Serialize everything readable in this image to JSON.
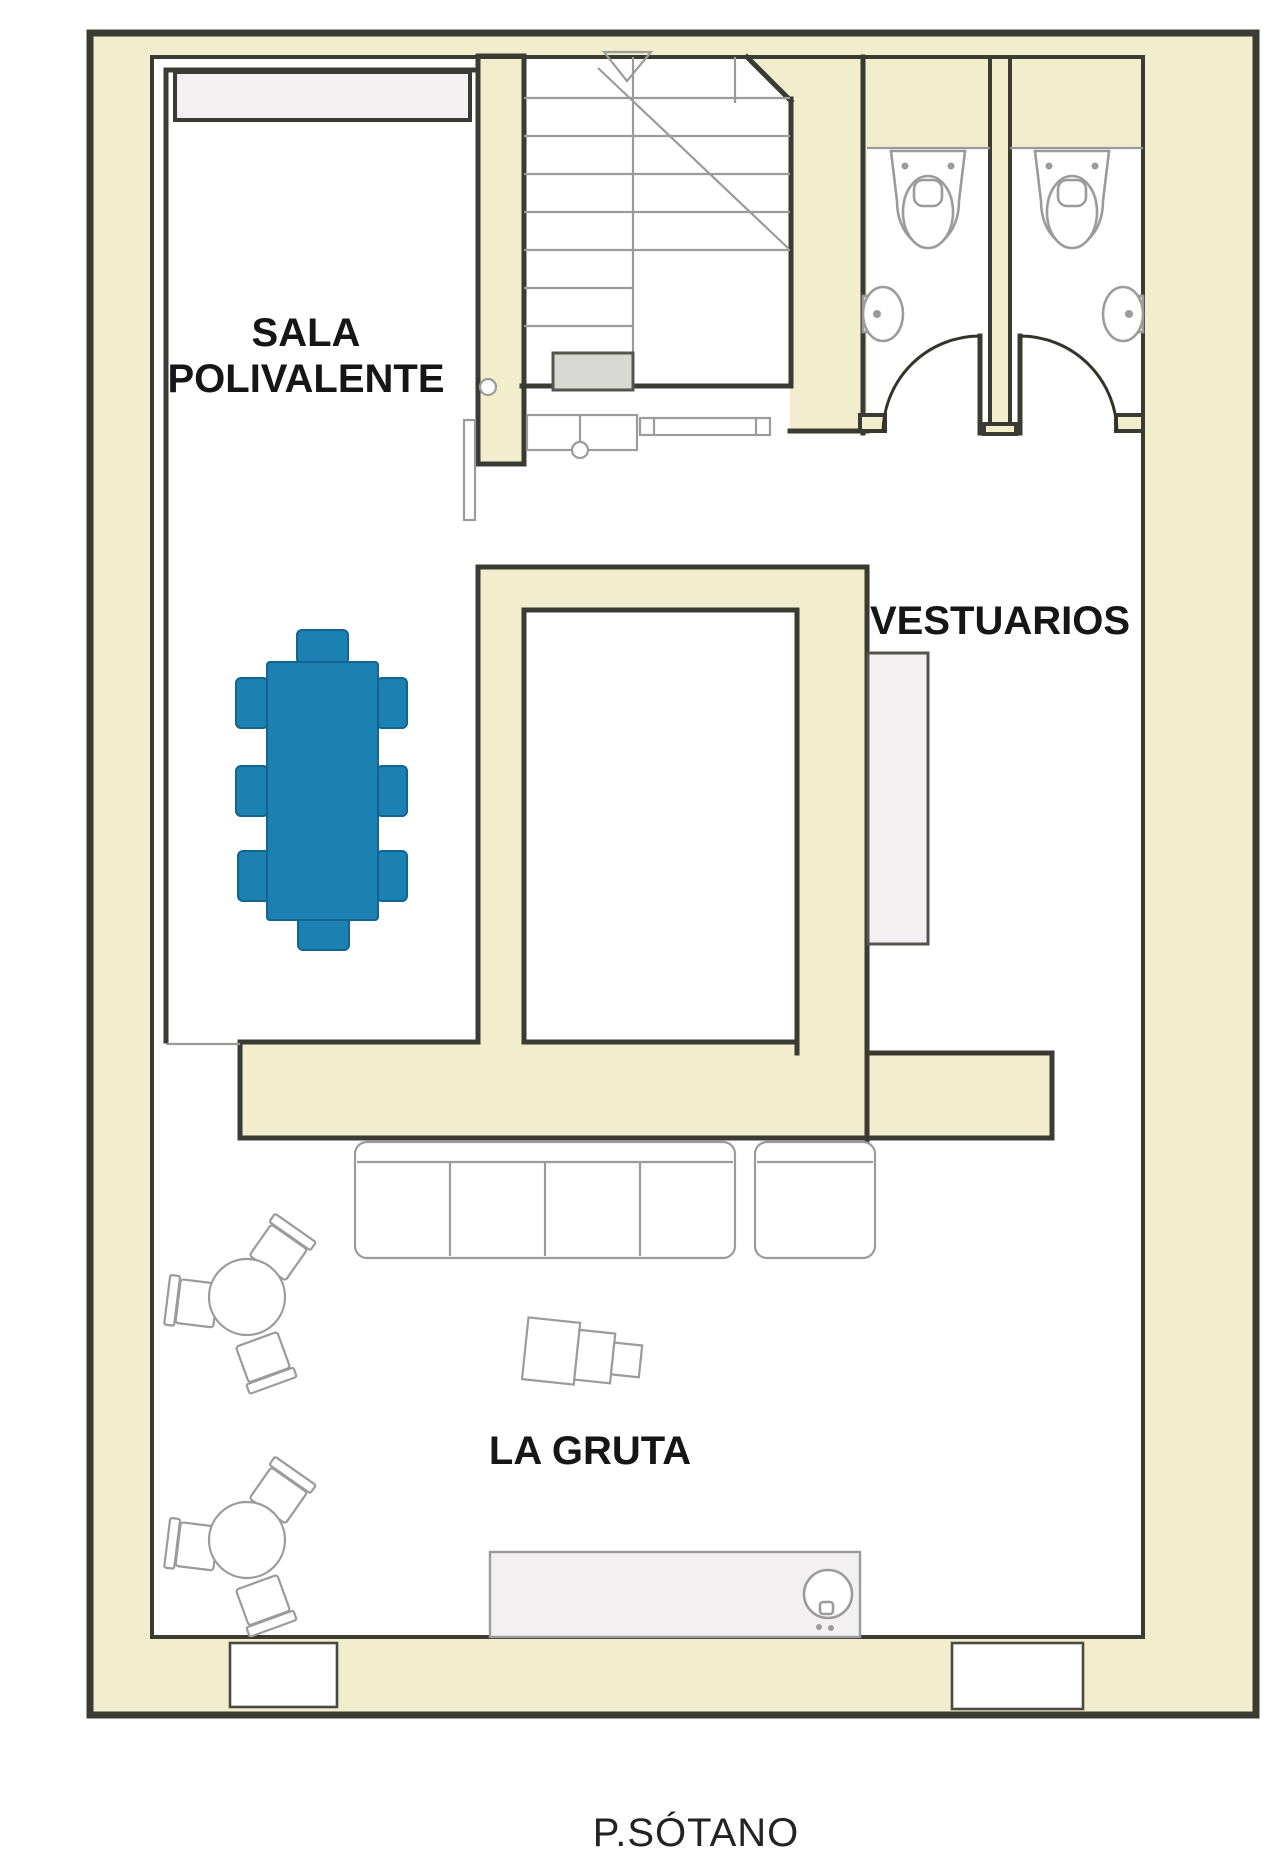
{
  "drawing": {
    "type": "architectural-floor-plan",
    "floor_label": "P.SÓTANO"
  },
  "rooms": {
    "sala": {
      "label_line1": "SALA",
      "label_line2": "POLIVALENTE"
    },
    "vestuarios": {
      "label": "VESTUARIOS"
    },
    "gruta": {
      "label": "LA GRUTA"
    }
  },
  "fixtures": [
    "stairs-with-down-arrow-icon",
    "toilet-icon",
    "toilet-icon",
    "wall-sink-icon",
    "wall-sink-icon",
    "door-swing-arc-icon",
    "door-swing-arc-icon",
    "door-leaf-icon",
    "meeting-table-with-chairs",
    "wardrobe-cabinet",
    "bench",
    "sofa-row",
    "sofa-short",
    "round-table-with-chairs",
    "round-table-with-chairs",
    "armchair-with-side-tables",
    "bar-counter-with-sink"
  ],
  "colors": {
    "background": "#ffffff",
    "wall": "#f2eecd",
    "line": "#3b3b33",
    "thin": "#9b9b9b",
    "accent": "#1b80b2",
    "accent_dark": "#14648e",
    "fixture": "#f3f0f2",
    "stairfill": "#d8d8d5"
  }
}
